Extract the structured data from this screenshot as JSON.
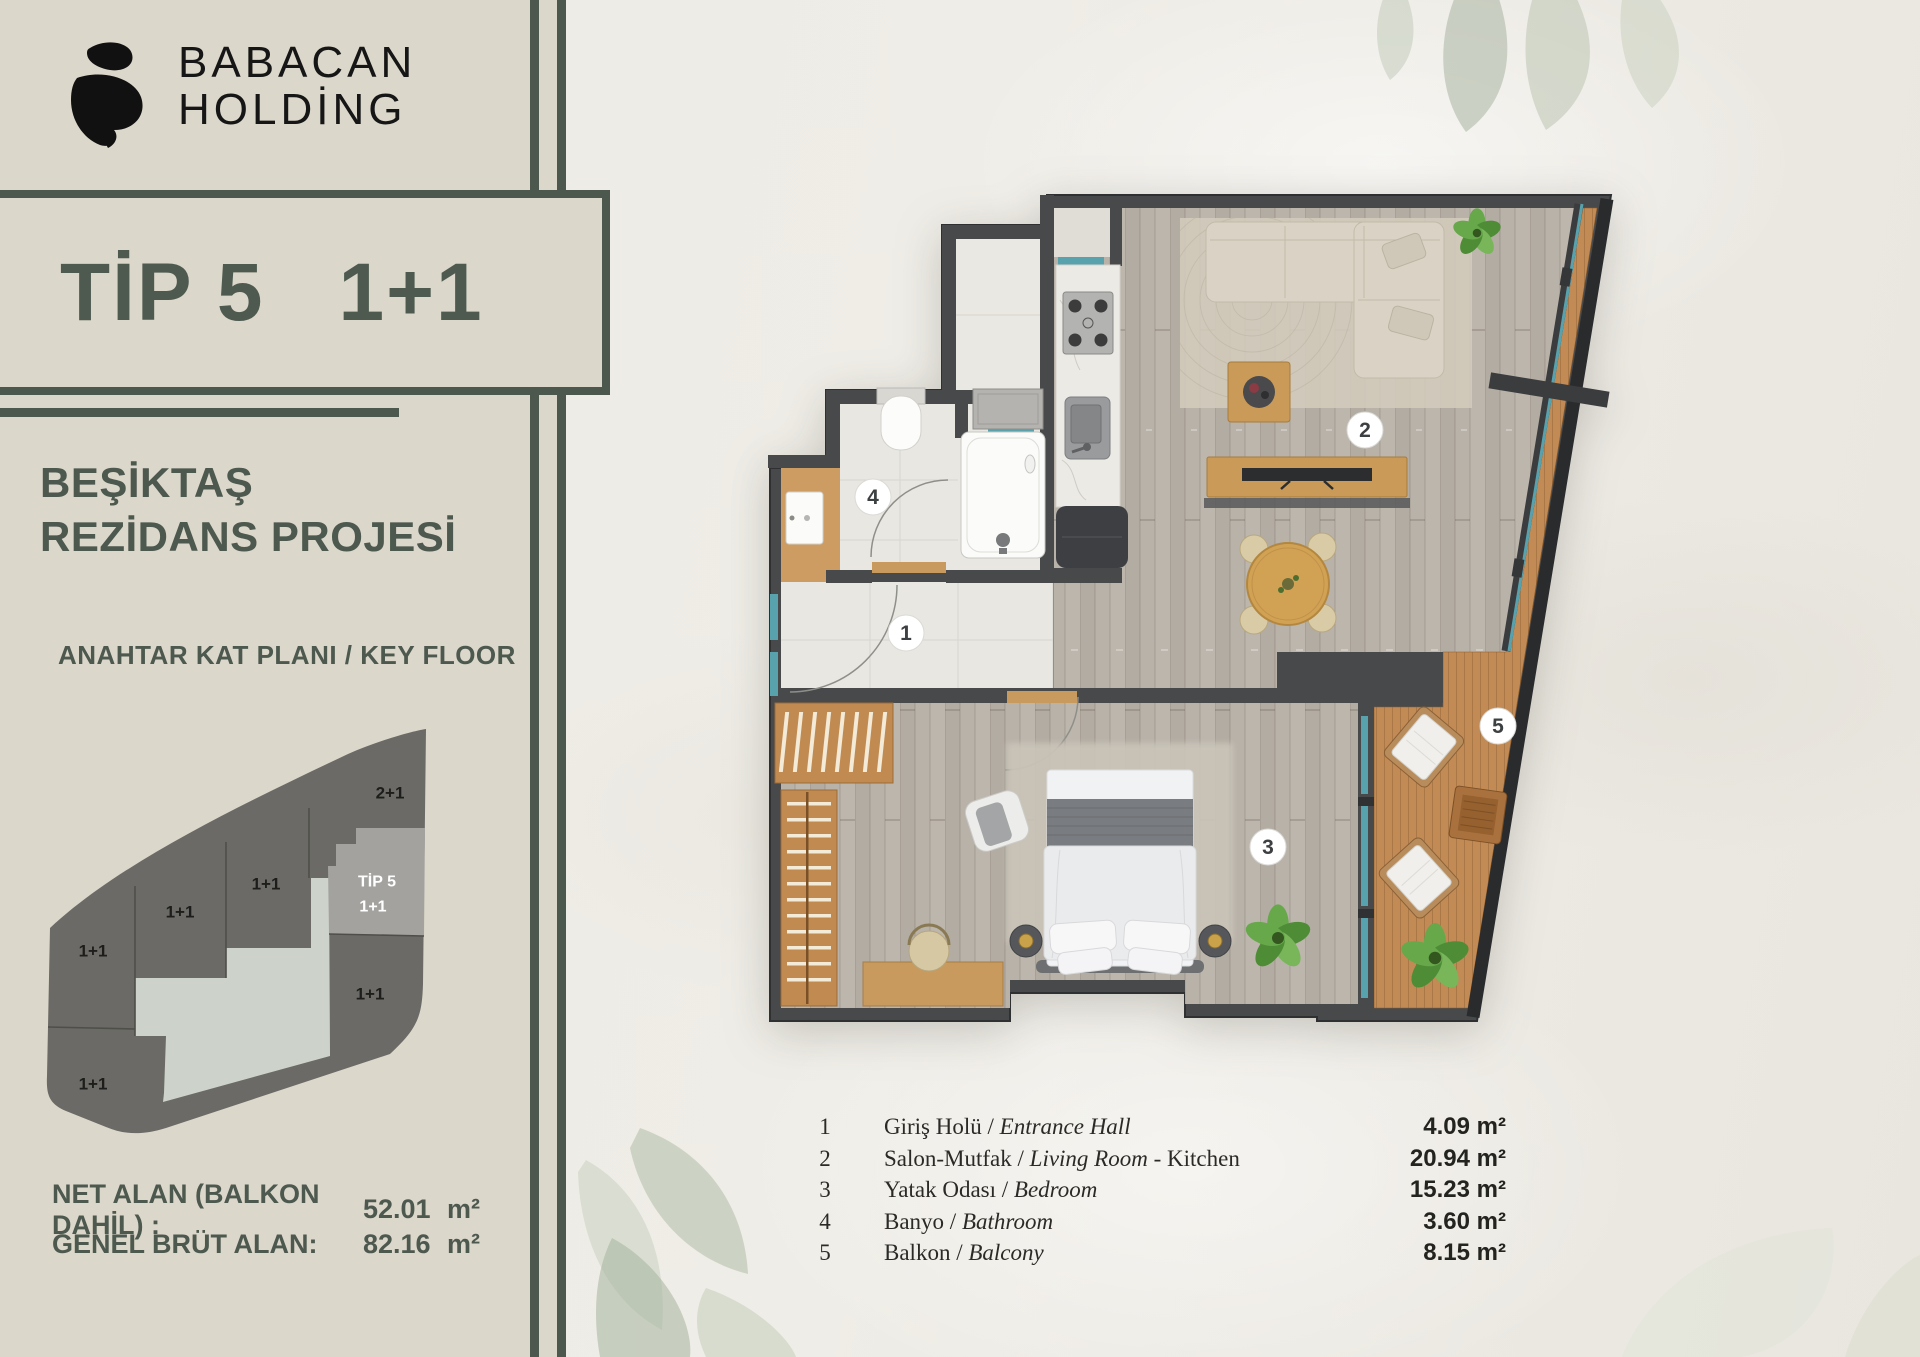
{
  "brand": {
    "line1": "BABACAN",
    "line2": "HOLDİNG",
    "mark": "babacan-b-monogram"
  },
  "title": {
    "type": "TİP 5",
    "layout": "1+1"
  },
  "project": {
    "line1": "BEŞİKTAŞ",
    "line2": "REZİDANS PROJESİ"
  },
  "key_plan": {
    "caption": "ANAHTAR KAT PLANI / KEY FLOOR",
    "highlight_line1": "TİP 5",
    "highlight_line2": "1+1",
    "units": [
      "2+1",
      "1+1",
      "1+1",
      "1+1",
      "1+1",
      "1+1"
    ]
  },
  "areas": {
    "items": [
      {
        "label": "NET ALAN (BALKON DAHİL) :",
        "value": "52.01",
        "unit": "m²"
      },
      {
        "label": "GENEL BRÜT ALAN:",
        "value": "82.16",
        "unit": "m²"
      }
    ]
  },
  "floor_plan": {
    "room_markers": [
      "1",
      "2",
      "3",
      "4",
      "5"
    ]
  },
  "legend": {
    "items": [
      {
        "no": "1",
        "tr": "Giriş Holü /",
        "en": "Entrance Hall",
        "rest": "",
        "area": "4.09",
        "unit": "m²"
      },
      {
        "no": "2",
        "tr": "Salon-Mutfak /",
        "en": "Living Room",
        "rest": "- Kitchen",
        "area": "20.94",
        "unit": "m²"
      },
      {
        "no": "3",
        "tr": "Yatak Odası /",
        "en": "Bedroom",
        "rest": "",
        "area": "15.23",
        "unit": "m²"
      },
      {
        "no": "4",
        "tr": "Banyo /",
        "en": "Bathroom",
        "rest": "",
        "area": "3.60",
        "unit": "m²"
      },
      {
        "no": "5",
        "tr": "Balkon /",
        "en": "Balcony",
        "rest": "",
        "area": "8.15",
        "unit": "m²"
      }
    ]
  },
  "colors": {
    "accent": "#4C584E",
    "sidebar_bg": "#DBD7CA",
    "paper": "#ECEAE3",
    "wall": "#48494B",
    "deck_wood": "#C28B55",
    "furniture_wood": "#C89A5E",
    "window_glass": "#58A2AE",
    "key_plan_dark": "#6B6A66",
    "key_plan_core": "#CDD3CB",
    "key_plan_highlight": "#A3A29F"
  }
}
